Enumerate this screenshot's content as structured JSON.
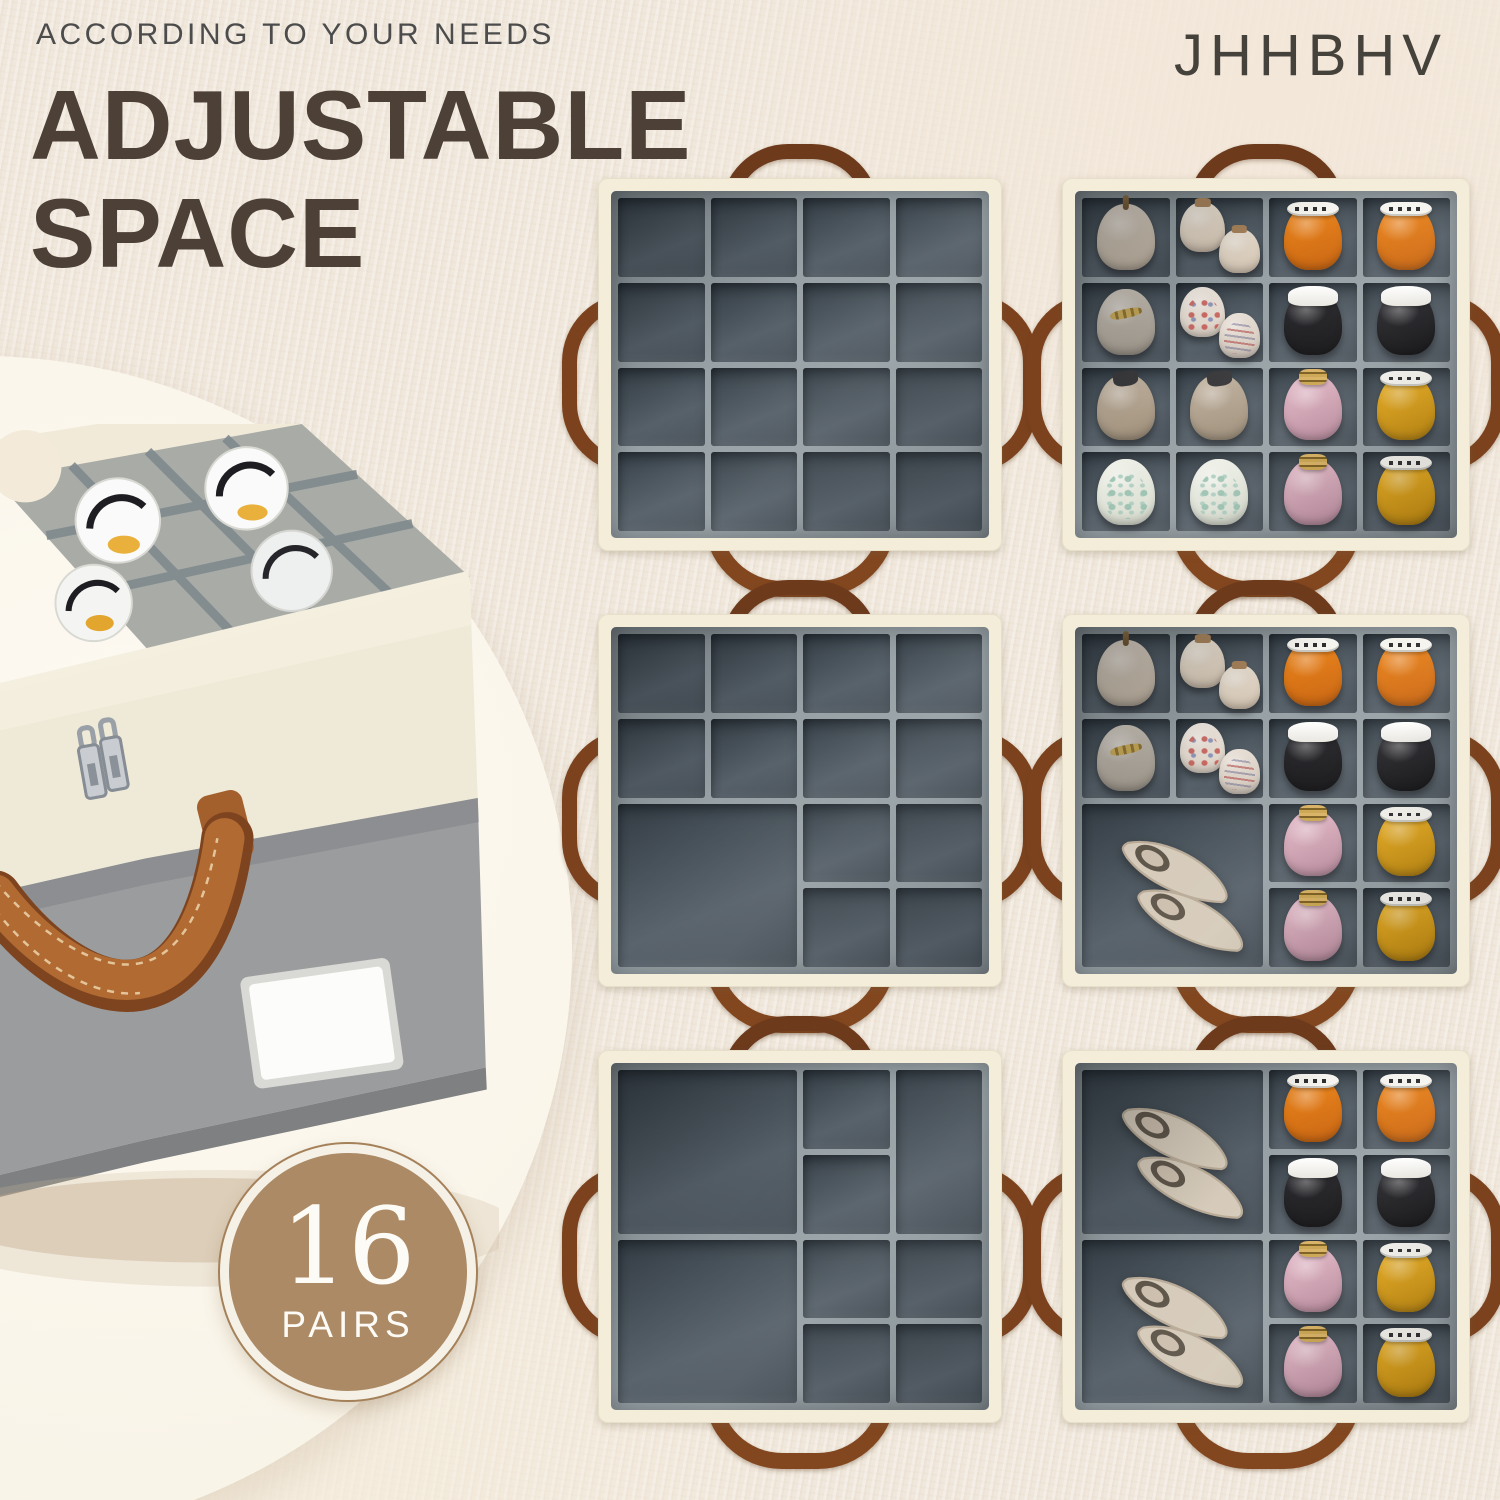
{
  "header": {
    "eyebrow": "ACCORDING TO YOUR NEEDS",
    "title_line1": "ADJUSTABLE",
    "title_line2": "SPACE",
    "brand": "JHHBHV"
  },
  "badge": {
    "number": "16",
    "label": "PAIRS"
  },
  "colors": {
    "background_carpet": "#f0e8dc",
    "title_text": "#4d4037",
    "eyebrow_text": "#4c4c4c",
    "brand_text": "#45413b",
    "badge_fill": "#ab8a65",
    "badge_ring": "#f6f1e6",
    "box_rim_cream": "#f3edda",
    "divider_grey_dark": "#49525a",
    "divider_grey_light": "#98a2a6",
    "handle_leather_brown": "#83471f",
    "product_front_cream": "#efe9d7",
    "product_front_grey": "#9b9c9e",
    "photo_circle": "#f9f4e8"
  },
  "product_photo": {
    "subject": "fabric shoe storage box with open lid, grey suede dividers, white sneakers inside, brown leather handle, double silver zippers, blank white label"
  },
  "shoe_styles": {
    "beige-heel": {
      "kind": "toe",
      "body1": "#ddd3c6",
      "body2": "#c3b5a3",
      "stem": true
    },
    "cream-pump": {
      "kind": "toe",
      "body1": "#f0e7d9",
      "body2": "#d8c8b5",
      "cap": true
    },
    "orange-sneaker": {
      "kind": "toe",
      "body1": "#ef8a1f",
      "body2": "#c96410",
      "band": "label"
    },
    "black-sneaker": {
      "kind": "toe",
      "body1": "#2e2e33",
      "body2": "#121214",
      "cuff": true
    },
    "taupe-flat": {
      "kind": "toe",
      "body1": "#cfc8bd",
      "body2": "#a29a8e",
      "gold": true
    },
    "floral-shoe": {
      "kind": "toe",
      "body1": "#f1eae2",
      "body2": "#ddd2c6",
      "print": "floral"
    },
    "striped-shoe": {
      "kind": "toe",
      "body1": "#e9e1d8",
      "body2": "#d2c7bb",
      "print": "stripes"
    },
    "loafer": {
      "kind": "toe",
      "body1": "#c4b6a4",
      "body2": "#9d8d78",
      "capdark": true
    },
    "pink-patent": {
      "kind": "toe",
      "body1": "#e3b9c6",
      "body2": "#bd8da0",
      "rings": true
    },
    "yellow-sneaker": {
      "kind": "toe",
      "body1": "#efb222",
      "body2": "#c28a0e",
      "band": "label"
    },
    "map-shoe": {
      "kind": "toe",
      "body1": "#f0f2ea",
      "body2": "#d6dacc",
      "print": "map"
    },
    "flats-pair": {
      "kind": "pair",
      "body1": "#d6cbba",
      "body2": "#b9ab97",
      "opening": "#5f564a",
      "sole": "#cdbfae"
    }
  },
  "panels": [
    {
      "id": 1,
      "side": "empty",
      "compartments": 16,
      "uniform_grid": [
        4,
        4
      ],
      "cells": []
    },
    {
      "id": 2,
      "side": "filled",
      "compartments": 16,
      "uniform_grid": [
        4,
        4
      ],
      "cells": [
        {
          "r": 1,
          "c": 1,
          "s": [
            "beige-heel"
          ]
        },
        {
          "r": 1,
          "c": 2,
          "s": [
            "cream-pump",
            "cream-pump"
          ]
        },
        {
          "r": 1,
          "c": 3,
          "s": [
            "orange-sneaker"
          ]
        },
        {
          "r": 1,
          "c": 4,
          "s": [
            "orange-sneaker"
          ]
        },
        {
          "r": 2,
          "c": 1,
          "s": [
            "taupe-flat"
          ]
        },
        {
          "r": 2,
          "c": 2,
          "s": [
            "floral-shoe",
            "striped-shoe"
          ]
        },
        {
          "r": 2,
          "c": 3,
          "s": [
            "black-sneaker"
          ]
        },
        {
          "r": 2,
          "c": 4,
          "s": [
            "black-sneaker"
          ]
        },
        {
          "r": 3,
          "c": 1,
          "s": [
            "loafer"
          ]
        },
        {
          "r": 3,
          "c": 2,
          "s": [
            "loafer"
          ]
        },
        {
          "r": 3,
          "c": 3,
          "s": [
            "pink-patent"
          ]
        },
        {
          "r": 3,
          "c": 4,
          "s": [
            "yellow-sneaker"
          ]
        },
        {
          "r": 4,
          "c": 1,
          "s": [
            "map-shoe"
          ]
        },
        {
          "r": 4,
          "c": 2,
          "s": [
            "map-shoe"
          ]
        },
        {
          "r": 4,
          "c": 3,
          "s": [
            "pink-patent"
          ]
        },
        {
          "r": 4,
          "c": 4,
          "s": [
            "yellow-sneaker"
          ]
        }
      ]
    },
    {
      "id": 3,
      "side": "empty",
      "compartments": 13,
      "cells": [
        {
          "r": 1,
          "c": 1
        },
        {
          "r": 1,
          "c": 2
        },
        {
          "r": 1,
          "c": 3
        },
        {
          "r": 1,
          "c": 4
        },
        {
          "r": 2,
          "c": 1
        },
        {
          "r": 2,
          "c": 2
        },
        {
          "r": 2,
          "c": 3
        },
        {
          "r": 2,
          "c": 4
        },
        {
          "r": 3,
          "c": 1,
          "rs": 2,
          "cs": 2
        },
        {
          "r": 3,
          "c": 3
        },
        {
          "r": 3,
          "c": 4
        },
        {
          "r": 4,
          "c": 3
        },
        {
          "r": 4,
          "c": 4
        }
      ]
    },
    {
      "id": 4,
      "side": "filled",
      "compartments": 13,
      "cells": [
        {
          "r": 1,
          "c": 1,
          "s": [
            "beige-heel"
          ]
        },
        {
          "r": 1,
          "c": 2,
          "s": [
            "cream-pump",
            "cream-pump"
          ]
        },
        {
          "r": 1,
          "c": 3,
          "s": [
            "orange-sneaker"
          ]
        },
        {
          "r": 1,
          "c": 4,
          "s": [
            "orange-sneaker"
          ]
        },
        {
          "r": 2,
          "c": 1,
          "s": [
            "taupe-flat"
          ]
        },
        {
          "r": 2,
          "c": 2,
          "s": [
            "floral-shoe",
            "striped-shoe"
          ]
        },
        {
          "r": 2,
          "c": 3,
          "s": [
            "black-sneaker"
          ]
        },
        {
          "r": 2,
          "c": 4,
          "s": [
            "black-sneaker"
          ]
        },
        {
          "r": 3,
          "c": 1,
          "rs": 2,
          "cs": 2,
          "s": [
            "flats-pair"
          ]
        },
        {
          "r": 3,
          "c": 3,
          "s": [
            "pink-patent"
          ]
        },
        {
          "r": 3,
          "c": 4,
          "s": [
            "yellow-sneaker"
          ]
        },
        {
          "r": 4,
          "c": 3,
          "s": [
            "pink-patent"
          ]
        },
        {
          "r": 4,
          "c": 4,
          "s": [
            "yellow-sneaker"
          ]
        }
      ]
    },
    {
      "id": 5,
      "side": "empty",
      "compartments": 9,
      "cells": [
        {
          "r": 1,
          "c": 1,
          "rs": 2,
          "cs": 2
        },
        {
          "r": 3,
          "c": 1,
          "rs": 2,
          "cs": 2
        },
        {
          "r": 1,
          "c": 3
        },
        {
          "r": 2,
          "c": 3
        },
        {
          "r": 1,
          "c": 4,
          "rs": 2
        },
        {
          "r": 3,
          "c": 3
        },
        {
          "r": 3,
          "c": 4
        },
        {
          "r": 4,
          "c": 3
        },
        {
          "r": 4,
          "c": 4
        }
      ]
    },
    {
      "id": 6,
      "side": "filled",
      "compartments": 10,
      "cells": [
        {
          "r": 1,
          "c": 1,
          "rs": 2,
          "cs": 2,
          "s": [
            "flats-pair"
          ]
        },
        {
          "r": 3,
          "c": 1,
          "rs": 2,
          "cs": 2,
          "s": [
            "flats-pair"
          ]
        },
        {
          "r": 1,
          "c": 3,
          "s": [
            "orange-sneaker"
          ]
        },
        {
          "r": 1,
          "c": 4,
          "s": [
            "orange-sneaker"
          ]
        },
        {
          "r": 2,
          "c": 3,
          "s": [
            "black-sneaker"
          ]
        },
        {
          "r": 2,
          "c": 4,
          "s": [
            "black-sneaker"
          ]
        },
        {
          "r": 3,
          "c": 3,
          "s": [
            "pink-patent"
          ]
        },
        {
          "r": 3,
          "c": 4,
          "s": [
            "yellow-sneaker"
          ]
        },
        {
          "r": 4,
          "c": 3,
          "s": [
            "pink-patent"
          ]
        },
        {
          "r": 4,
          "c": 4,
          "s": [
            "yellow-sneaker"
          ]
        }
      ]
    }
  ]
}
